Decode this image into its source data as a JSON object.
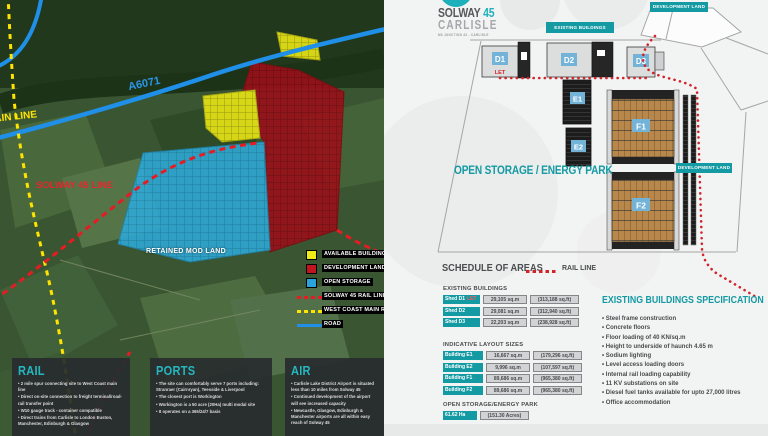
{
  "brand": {
    "name_primary": "SOLWAY",
    "name_number": "45",
    "name_city": "CARLISLE",
    "tagline": "M6 JUNCTION 43 - CARLISLE"
  },
  "map": {
    "labels": {
      "road": "A6071",
      "main_line": "MAIN LINE",
      "solway_line": "SOLWAY 45 LINE",
      "retained": "RETAINED MOD LAND"
    },
    "legend": {
      "items": [
        {
          "label": "AVAILABLE BUILDINGS",
          "swatch": "yellow-square",
          "color": "#f0ea18"
        },
        {
          "label": "DEVELOPMENT LAND",
          "swatch": "red-square",
          "color": "#c01420"
        },
        {
          "label": "OPEN STORAGE",
          "swatch": "blue-square",
          "color": "#2aa3dc"
        },
        {
          "label": "SOLWAY 45 RAIL LINE",
          "swatch": "red-dashed-line",
          "color": "#e51c23"
        },
        {
          "label": "WEST COAST MAIN RAIL LINE",
          "swatch": "yellow-dashed-line",
          "color": "#ffe400"
        },
        {
          "label": "ROAD",
          "swatch": "blue-line",
          "color": "#1f8fe8"
        }
      ]
    },
    "cards": [
      {
        "title": "RAIL",
        "bullets": [
          "2 mile spur connecting site to West Coast main line",
          "Direct on-site connection to freight terminal/road-rail transfer point",
          "W10 gauge track - container compatible",
          "Direct trains from Carlisle to London Euston, Manchester, Edinburgh & Glasgow"
        ]
      },
      {
        "title": "PORTS",
        "bullets": [
          "The site can comfortably serve 7 ports including: Stranraer (Cairnryan), Teesside & Liverpool",
          "The closest port is Workington",
          "Workington is a 50 acre (20Ha) multi modal site",
          "It operates on a 365/24/7 basis"
        ]
      },
      {
        "title": "AIR",
        "bullets": [
          "Carlisle Lake District Airport is situated less than 10 miles from Solway 45",
          "Continued development of the airport will see increased capacity",
          "Newcastle, Glasgow, Edinburgh & Manchester airports are all within easy reach of Solway 45"
        ]
      }
    ]
  },
  "plan": {
    "tags": {
      "existing_buildings": "EXISTING BUILDINGS",
      "development_land_top": "DEVELOPMENT LAND",
      "development_land_mid": "DEVELOPMENT LAND"
    },
    "open_storage_label": "OPEN STORAGE / ENERGY PARK",
    "let_label": "LET",
    "buildings": {
      "d1": "D1",
      "d2": "D2",
      "d3": "D3",
      "e1": "E1",
      "e2": "E2",
      "f1": "F1",
      "f2": "F2"
    }
  },
  "schedule": {
    "title": "SCHEDULE OF AREAS",
    "rail_line_label": "RAIL LINE",
    "sections": [
      {
        "heading": "EXISTING BUILDINGS",
        "rows": [
          {
            "label": "Shed D1",
            "tag": "LET",
            "metric": "29,105 sq.m",
            "imperial": "(313,188 sq.ft)"
          },
          {
            "label": "Shed D2",
            "metric": "29,081 sq.m",
            "imperial": "(312,940 sq.ft)"
          },
          {
            "label": "Shed D3",
            "metric": "22,203 sq.m",
            "imperial": "(238,928 sq.ft)"
          }
        ]
      },
      {
        "heading": "INDICATIVE LAYOUT SIZES",
        "rows": [
          {
            "label": "Building E1",
            "metric": "16,667 sq.m",
            "imperial": "(179,296 sq.ft)"
          },
          {
            "label": "Building E2",
            "metric": "9,996 sq.m",
            "imperial": "(107,597 sq.ft)"
          },
          {
            "label": "Building F1",
            "metric": "89,686 sq.m",
            "imperial": "(965,380 sq.ft)"
          },
          {
            "label": "Building F2",
            "metric": "89,686 sq.m",
            "imperial": "(965,380 sq.ft)"
          }
        ]
      },
      {
        "heading": "OPEN STORAGE/ENERGY PARK",
        "rows": [
          {
            "label": "61.62 Ha",
            "imperial": "(151.30 Acres)"
          }
        ]
      }
    ]
  },
  "spec": {
    "title": "EXISTING BUILDINGS SPECIFICATION",
    "bullets": [
      "Steel frame construction",
      "Concrete floors",
      "Floor loading of 40 KN/sq.m",
      "Height to underside of haunch 4.65 m",
      "Sodium lighting",
      "Level access loading doors",
      "Internal rail loading capability",
      "11 KV substations on site",
      "Diesel fuel tanks available for upto 27,000 litres",
      "Office accommodation"
    ]
  },
  "colors": {
    "brand_teal": "#149aa3",
    "logo_teal": "#1fb0bd",
    "rail_red": "#d2232a",
    "let_red": "#ff5a52",
    "road_blue": "#1f8fe8",
    "west_coast_yellow": "#ffe400",
    "zone_yellow": "#e9e616",
    "zone_red": "#9b1019",
    "zone_blue": "#2fa8d5",
    "table_cell_gray": "#d2d3d4",
    "dark_text": "#4a4b4d"
  }
}
